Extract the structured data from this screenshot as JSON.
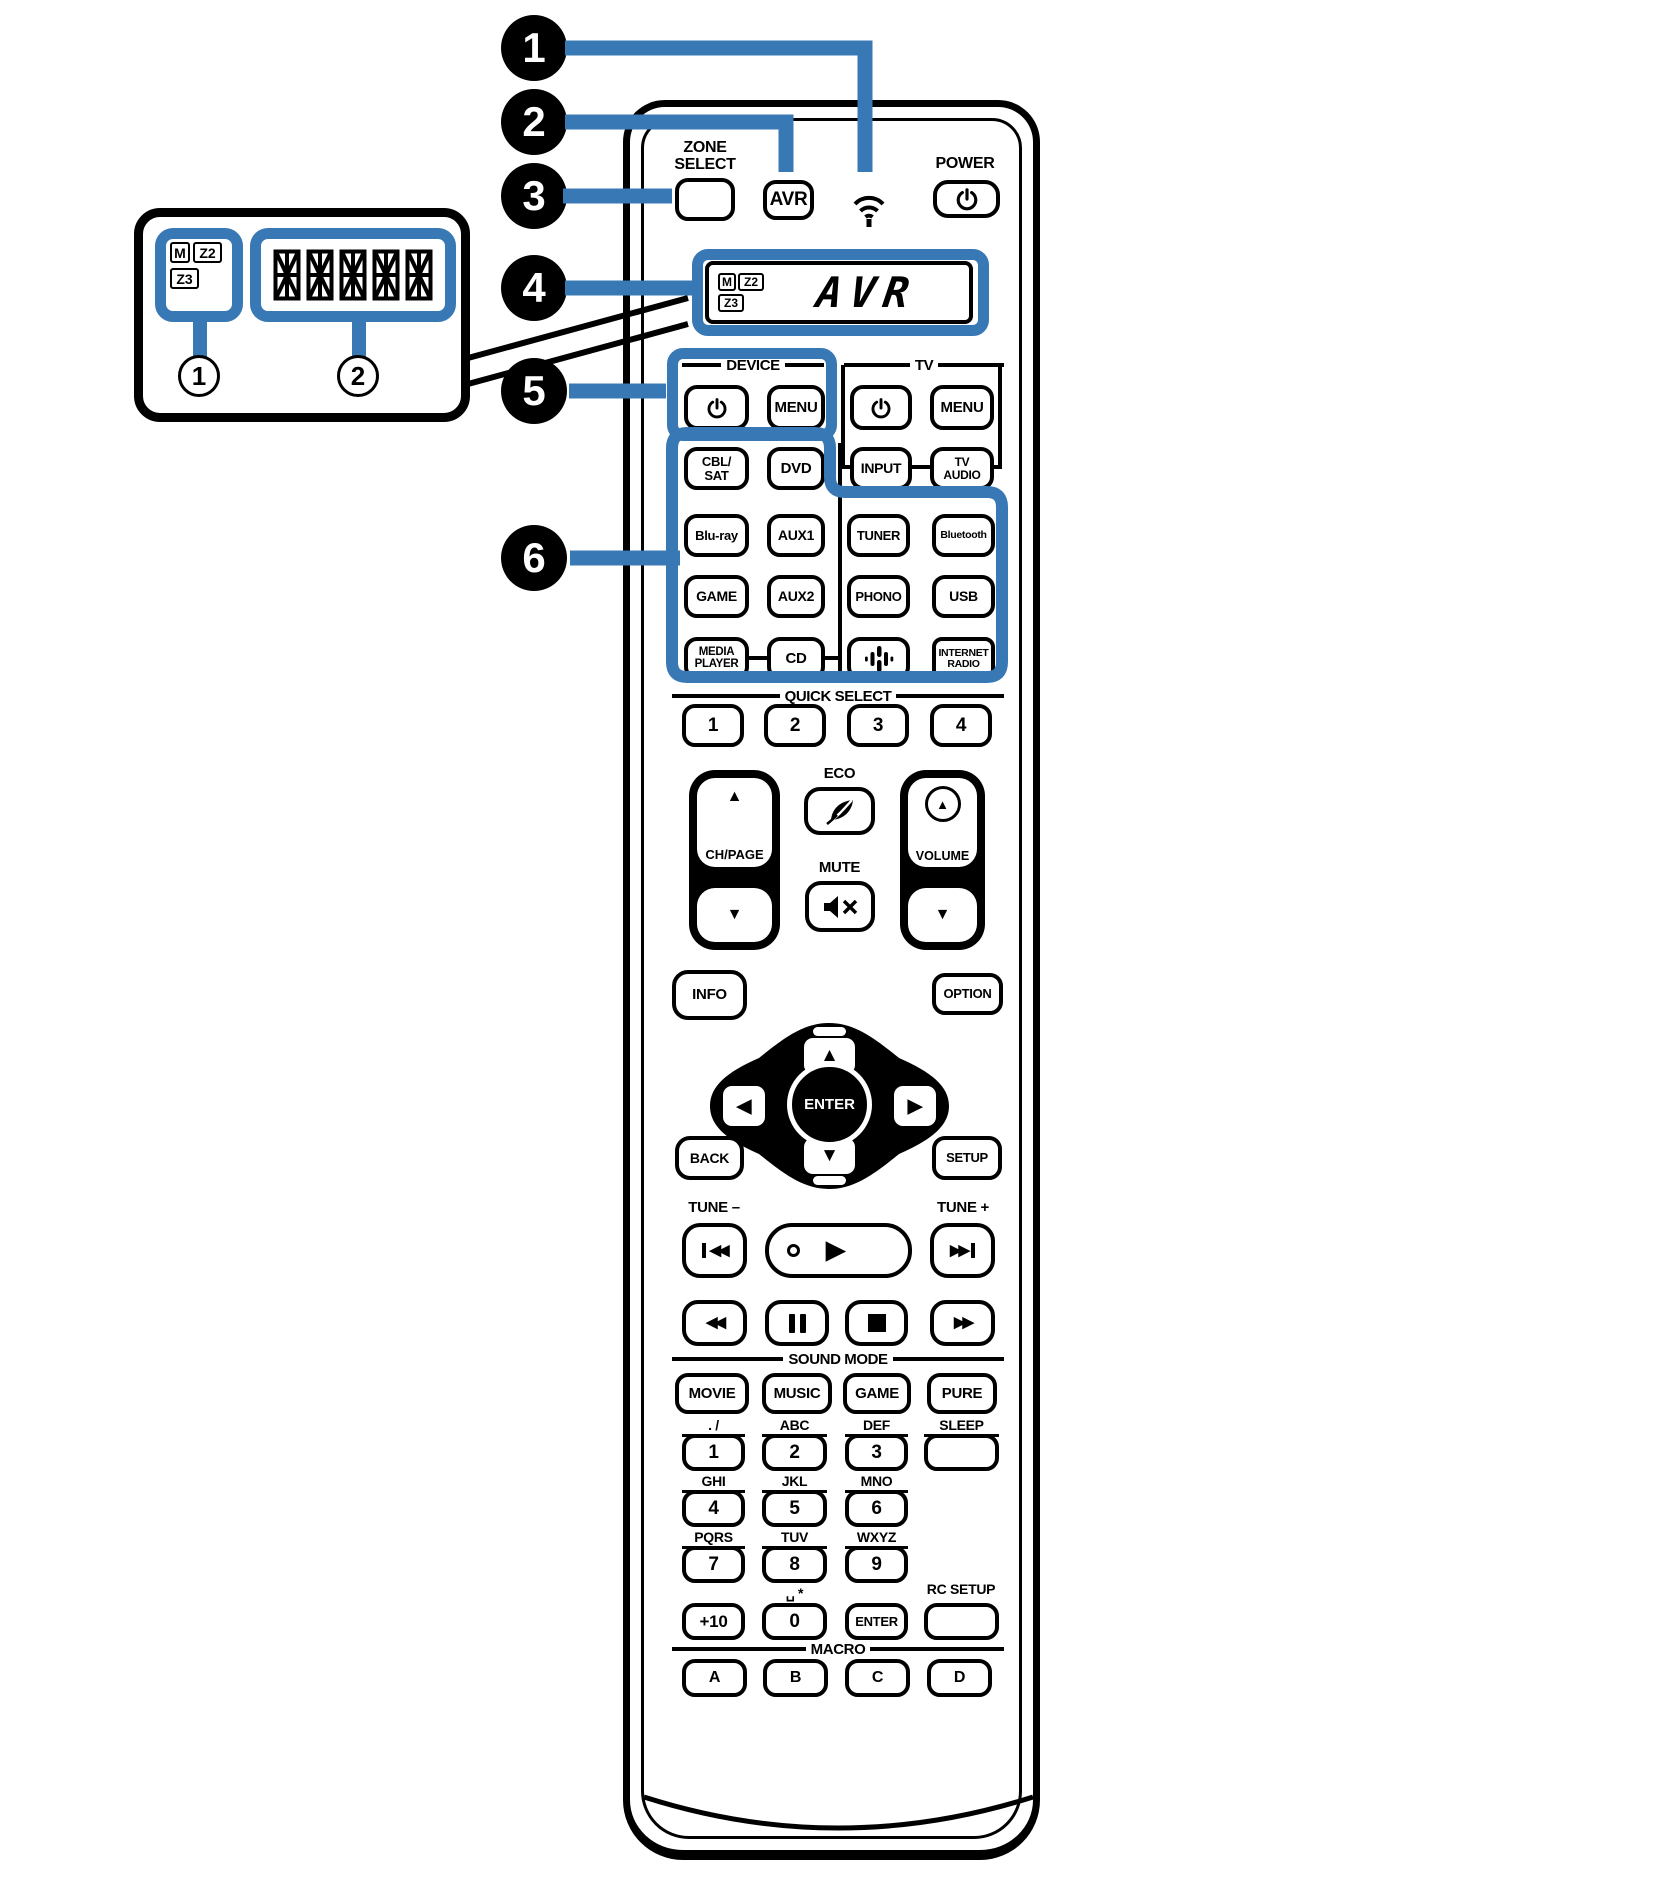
{
  "colors": {
    "accent_blue": "#3878b4",
    "ink": "#000000",
    "background": "#ffffff"
  },
  "callouts": {
    "items": [
      "1",
      "2",
      "3",
      "4",
      "5",
      "6"
    ]
  },
  "inset": {
    "m": "M",
    "z2": "Z2",
    "z3": "Z3",
    "num1": "1",
    "num2": "2",
    "segment_blocks": 5
  },
  "display": {
    "m": "M",
    "z2": "Z2",
    "z3": "Z3",
    "text": "AVR"
  },
  "top": {
    "zone_select": [
      "ZONE",
      "SELECT"
    ],
    "avr": "AVR",
    "power": "POWER"
  },
  "sections": {
    "device": "DEVICE",
    "tv": "TV",
    "quick_select": "QUICK SELECT",
    "sound_mode": "SOUND MODE",
    "macro": "MACRO"
  },
  "device_tv": {
    "device_menu": "MENU",
    "tv_menu": "MENU",
    "input": "INPUT",
    "tv_audio": [
      "TV",
      "AUDIO"
    ]
  },
  "inputs": {
    "cbl_sat": [
      "CBL/",
      "SAT"
    ],
    "dvd": "DVD",
    "bluray": "Blu-ray",
    "aux1": "AUX1",
    "tuner": "TUNER",
    "bluetooth": "Bluetooth",
    "game": "GAME",
    "aux2": "AUX2",
    "phono": "PHONO",
    "usb": "USB",
    "media_player": [
      "MEDIA",
      "PLAYER"
    ],
    "cd": "CD",
    "internet_radio": [
      "INTERNET",
      "RADIO"
    ]
  },
  "quick_select": [
    "1",
    "2",
    "3",
    "4"
  ],
  "center": {
    "ch_page": "CH/PAGE",
    "eco": "ECO",
    "mute": "MUTE",
    "volume": "VOLUME",
    "info": "INFO",
    "option": "OPTION",
    "enter": "ENTER",
    "back": "BACK",
    "setup": "SETUP"
  },
  "transport": {
    "tune_minus": "TUNE –",
    "tune_plus": "TUNE +"
  },
  "sound_mode": [
    "MOVIE",
    "MUSIC",
    "GAME",
    "PURE"
  ],
  "keypad": {
    "labels": [
      ". /",
      "ABC",
      "DEF",
      "GHI",
      "JKL",
      "MNO",
      "PQRS",
      "TUV",
      "WXYZ"
    ],
    "digits": [
      "1",
      "2",
      "3",
      "4",
      "5",
      "6",
      "7",
      "8",
      "9"
    ],
    "sleep": "SLEEP",
    "plus10": "+10",
    "zero": "0",
    "zero_label": "␣ *",
    "enter": "ENTER",
    "rc_setup": "RC SETUP"
  },
  "macro": [
    "A",
    "B",
    "C",
    "D"
  ],
  "glyphs": {
    "up": "▲",
    "down": "▼",
    "left": "◀",
    "right": "▶",
    "play": "▶",
    "rew": "◀◀",
    "ff": "▶▶",
    "skip_tris": "◀◀",
    "skip_tris_f": "▶▶"
  }
}
